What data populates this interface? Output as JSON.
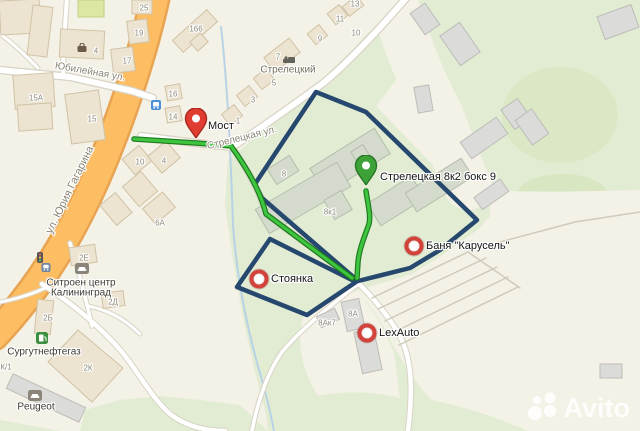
{
  "watermark": {
    "brand": "Avito"
  },
  "colors": {
    "area_outline_navy": "#27486e",
    "route_green": "#3ec43e",
    "route_casing": "#1d7a1d",
    "marker_red": "#e03c31",
    "marker_red_dark": "#a8271e",
    "pin_green": "#3da339",
    "pin_green_dark": "#2a7527",
    "ring_red": "#d2413a",
    "road_orange": "#fdbd62",
    "water_blue": "#b3cfe6",
    "green_area": "#e1ecd3"
  },
  "markers": [
    {
      "id": "most",
      "type": "pin-red",
      "x": 196,
      "y": 143,
      "label": "Мост",
      "dx": 12,
      "dy": -17
    },
    {
      "id": "target",
      "type": "pin-green",
      "x": 366,
      "y": 190,
      "label": "Стрелецкая 8к2 бокс 9",
      "dx": 14,
      "dy": -13
    },
    {
      "id": "banya",
      "type": "ring",
      "x": 414,
      "y": 246,
      "label": "Баня \"Карусель\"",
      "dx": 12,
      "dy": 0
    },
    {
      "id": "stoyanka",
      "type": "ring",
      "x": 259,
      "y": 279,
      "label": "Стоянка",
      "dx": 12,
      "dy": 0
    },
    {
      "id": "lexauto",
      "type": "ring",
      "x": 367,
      "y": 333,
      "label": "LexAuto",
      "dx": 12,
      "dy": 0
    }
  ],
  "street_labels": [
    {
      "t": "Юбилейная ул.",
      "x": 90,
      "y": 72,
      "rot": 10,
      "size": 10
    },
    {
      "t": "ул. Юрия Гагарина",
      "x": 70,
      "y": 190,
      "rot": -64,
      "size": 11
    },
    {
      "t": "Стрелецкая ул.",
      "x": 242,
      "y": 138,
      "rot": -14,
      "size": 10
    }
  ],
  "place_labels": [
    {
      "t": "Стрелецкий",
      "x": 288,
      "y": 70
    }
  ],
  "poi_labels": [
    {
      "t": "Ситроен центр",
      "x": 81,
      "y": 283
    },
    {
      "t": "Калининград",
      "x": 81,
      "y": 293
    },
    {
      "t": "Сургутнефтегаз",
      "x": 44,
      "y": 352
    },
    {
      "t": "Peugeot",
      "x": 36,
      "y": 407
    }
  ],
  "house_numbers": [
    {
      "t": "25",
      "x": 144,
      "y": 8
    },
    {
      "t": "19",
      "x": 139,
      "y": 33
    },
    {
      "t": "17",
      "x": 127,
      "y": 61
    },
    {
      "t": "4",
      "x": 96,
      "y": 51
    },
    {
      "t": "166",
      "x": 196,
      "y": 29
    },
    {
      "t": "16",
      "x": 173,
      "y": 94
    },
    {
      "t": "14",
      "x": 173,
      "y": 117
    },
    {
      "t": "15A",
      "x": 36,
      "y": 98
    },
    {
      "t": "15",
      "x": 92,
      "y": 119
    },
    {
      "t": "13",
      "x": 355,
      "y": 4
    },
    {
      "t": "11",
      "x": 340,
      "y": 19
    },
    {
      "t": "9",
      "x": 320,
      "y": 39
    },
    {
      "t": "7",
      "x": 278,
      "y": 57
    },
    {
      "t": "5",
      "x": 274,
      "y": 83
    },
    {
      "t": "3",
      "x": 253,
      "y": 100
    },
    {
      "t": "1",
      "x": 238,
      "y": 121
    },
    {
      "t": "10",
      "x": 356,
      "y": 33
    },
    {
      "t": "10",
      "x": 140,
      "y": 162
    },
    {
      "t": "4",
      "x": 164,
      "y": 161
    },
    {
      "t": "6А",
      "x": 160,
      "y": 223
    },
    {
      "t": "8",
      "x": 284,
      "y": 174
    },
    {
      "t": "8к1",
      "x": 330,
      "y": 212
    },
    {
      "t": "2Е",
      "x": 84,
      "y": 258
    },
    {
      "t": "2Д",
      "x": 113,
      "y": 302
    },
    {
      "t": "2Б",
      "x": 48,
      "y": 318
    },
    {
      "t": "2К",
      "x": 88,
      "y": 368
    },
    {
      "t": "К/1",
      "x": 6,
      "y": 367
    },
    {
      "t": "8А",
      "x": 353,
      "y": 314
    },
    {
      "t": "8Ак7",
      "x": 327,
      "y": 323
    }
  ],
  "poi_icons": [
    {
      "type": "bag",
      "x": 82,
      "y": 49
    },
    {
      "type": "bed",
      "x": 289,
      "y": 60
    },
    {
      "type": "car",
      "x": 82,
      "y": 270
    },
    {
      "type": "car",
      "x": 35,
      "y": 397
    },
    {
      "type": "fuel",
      "x": 42,
      "y": 340
    },
    {
      "type": "transit",
      "x": 156,
      "y": 106
    },
    {
      "type": "traffic-light",
      "x": 40,
      "y": 259
    },
    {
      "type": "bus",
      "x": 46,
      "y": 268
    }
  ]
}
